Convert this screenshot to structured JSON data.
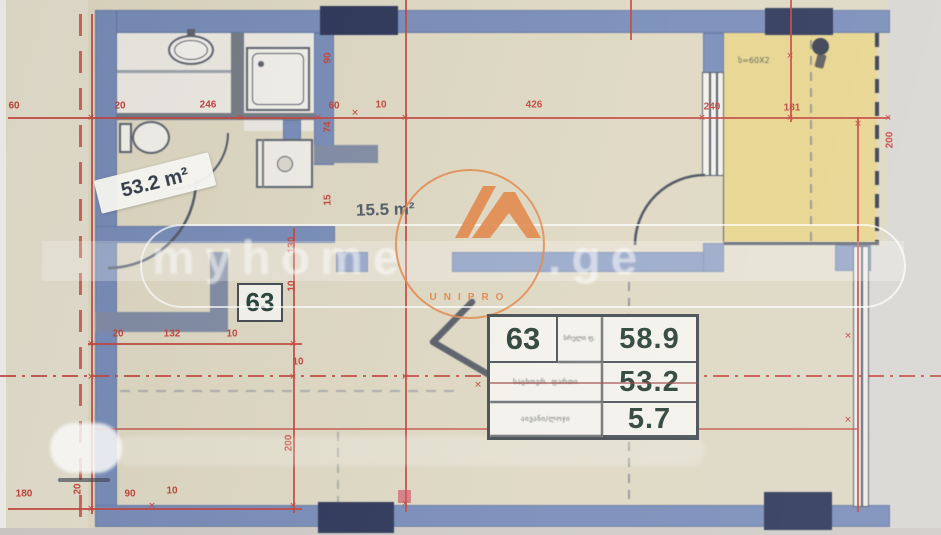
{
  "plan": {
    "unit_badge": "63",
    "sticker_area": "53.2 m²",
    "hall_area": "15.5 m²",
    "balcony_note": "ს=60X2",
    "area_table": {
      "unit": "63",
      "unit_sub_label": "სრული ფ.",
      "rows": [
        {
          "label": "",
          "value": "58.9"
        },
        {
          "label": "საცხოვრ. ფართი",
          "value": "53.2"
        },
        {
          "label": "აივანი/ლოჯი",
          "value": "5.7"
        }
      ]
    },
    "dimensions": [
      {
        "t": "60",
        "x": 14,
        "y": 106
      },
      {
        "t": "20",
        "x": 120,
        "y": 106
      },
      {
        "t": "246",
        "x": 208,
        "y": 105
      },
      {
        "t": "60",
        "x": 334,
        "y": 106
      },
      {
        "t": "10",
        "x": 381,
        "y": 105
      },
      {
        "t": "426",
        "x": 534,
        "y": 105
      },
      {
        "t": "240",
        "x": 712,
        "y": 107
      },
      {
        "t": "181",
        "x": 792,
        "y": 108
      },
      {
        "t": "90",
        "x": 328,
        "y": 58,
        "r": -90
      },
      {
        "t": "74",
        "x": 328,
        "y": 127,
        "r": -90
      },
      {
        "t": "15",
        "x": 328,
        "y": 200,
        "r": -90
      },
      {
        "t": "130",
        "x": 292,
        "y": 245,
        "r": -90
      },
      {
        "t": "10",
        "x": 292,
        "y": 286,
        "r": -90
      },
      {
        "t": "200",
        "x": 289,
        "y": 443,
        "r": -90
      },
      {
        "t": "20",
        "x": 118,
        "y": 334
      },
      {
        "t": "132",
        "x": 172,
        "y": 334
      },
      {
        "t": "10",
        "x": 232,
        "y": 334
      },
      {
        "t": "10",
        "x": 298,
        "y": 362
      },
      {
        "t": "180",
        "x": 24,
        "y": 494
      },
      {
        "t": "20",
        "x": 78,
        "y": 489,
        "r": -90
      },
      {
        "t": "90",
        "x": 130,
        "y": 494
      },
      {
        "t": "10",
        "x": 172,
        "y": 491
      },
      {
        "t": "200",
        "x": 890,
        "y": 140,
        "r": -90
      }
    ],
    "ticks": [
      {
        "x": 91,
        "y": 118
      },
      {
        "x": 240,
        "y": 118
      },
      {
        "x": 318,
        "y": 118
      },
      {
        "x": 405,
        "y": 118
      },
      {
        "x": 702,
        "y": 118
      },
      {
        "x": 790,
        "y": 118
      },
      {
        "x": 858,
        "y": 124
      },
      {
        "x": 888,
        "y": 118
      },
      {
        "x": 91,
        "y": 344
      },
      {
        "x": 293,
        "y": 344
      },
      {
        "x": 91,
        "y": 377
      },
      {
        "x": 293,
        "y": 377
      },
      {
        "x": 405,
        "y": 377
      },
      {
        "x": 848,
        "y": 336
      },
      {
        "x": 848,
        "y": 420
      },
      {
        "x": 91,
        "y": 509
      },
      {
        "x": 293,
        "y": 506
      },
      {
        "x": 405,
        "y": 504
      },
      {
        "x": 790,
        "y": 56
      },
      {
        "x": 478,
        "y": 385
      },
      {
        "x": 355,
        "y": 113
      },
      {
        "x": 152,
        "y": 506
      }
    ],
    "tick_glyph": "✕"
  },
  "watermark": {
    "site_left": "myhome",
    "site_right": ".ge",
    "logo_text": "UNIPRO"
  },
  "colors": {
    "wall": "#7287b5",
    "column": "#232d50",
    "balcony_fill": "#e6d288",
    "dimension_red": "#bf3c34",
    "paper": "#dcd6c0",
    "logo_orange": "#e07f3e"
  }
}
